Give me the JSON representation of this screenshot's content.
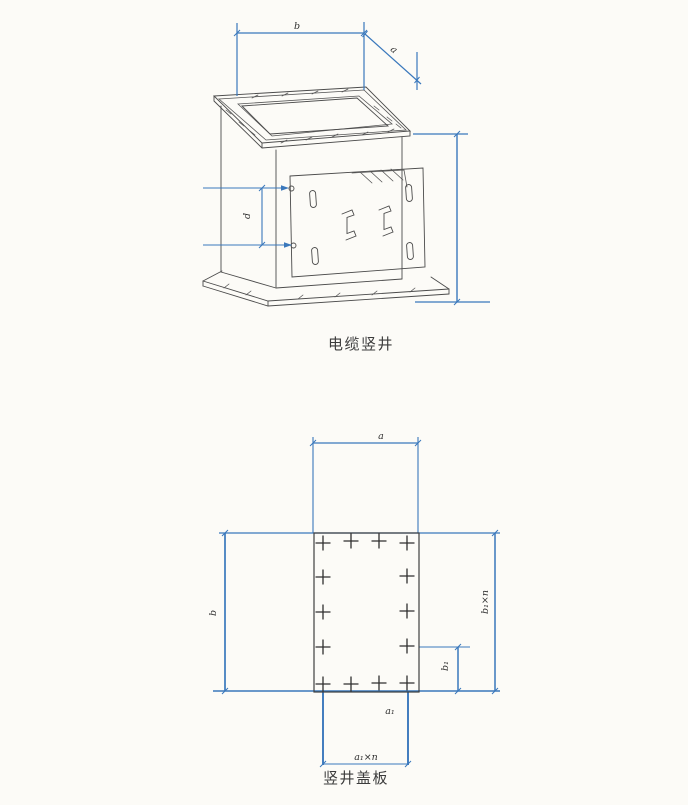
{
  "page": {
    "background": "#fcfbf7"
  },
  "colors": {
    "dimension_line": "#3a78bc",
    "drawing_line": "#4b4b4b",
    "label_text": "#2f2f2f"
  },
  "figure1": {
    "caption": "电缆竖井",
    "dim_b": "b",
    "dim_a": "a",
    "dim_d": "d"
  },
  "figure2": {
    "caption": "竖井盖板",
    "dim_a": "a",
    "dim_b": "b",
    "dim_b1n": "b₁×n",
    "dim_b1": "b₁",
    "dim_a1": "a₁",
    "dim_a1n": "a₁×n"
  }
}
